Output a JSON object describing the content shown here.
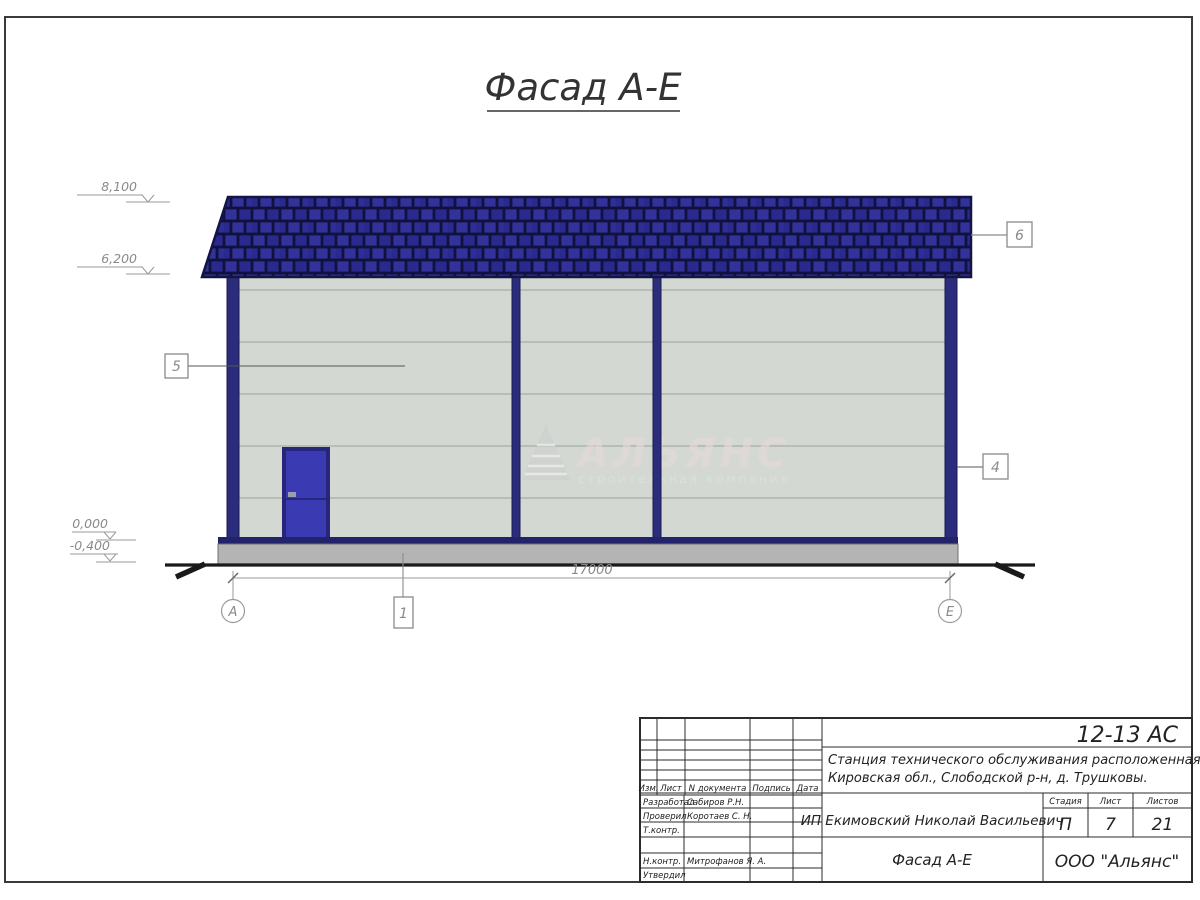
{
  "page": {
    "title": "Фасад А-Е"
  },
  "drawing": {
    "dimension_total": "17000",
    "axis_left": "А",
    "axis_right": "Е",
    "elevations": [
      "8,100",
      "6,200",
      "0,000",
      "-0,400"
    ],
    "callouts": {
      "c1": "1",
      "c4": "4",
      "c5": "5",
      "c6": "6"
    }
  },
  "watermark": {
    "name": "АЛЬЯНС",
    "subtitle": "строительная компания"
  },
  "title_block": {
    "doc_number": "12-13 АС",
    "project_line1": "Станция технического обслуживания расположенная по адресу",
    "project_line2": "Кировская обл., Слободской р-н, д. Трушковы.",
    "client": "ИП Екимовский Николай Васильевич",
    "sheet_title": "Фасад А-Е",
    "company": "ООО \"Альянс\"",
    "columns": {
      "izm": "Изм.",
      "list": "Лист",
      "doc": "N документа",
      "sign": "Подпись",
      "date": "Дата"
    },
    "rows": [
      {
        "role": "Разработал",
        "name": "Сабиров Р.Н."
      },
      {
        "role": "Проверил",
        "name": "Коротаев С. Н."
      },
      {
        "role": "Т.контр.",
        "name": ""
      },
      {
        "role": "Н.контр.",
        "name": "Митрофанов Я. А."
      },
      {
        "role": "Утвердил",
        "name": ""
      }
    ],
    "stage_header": {
      "stage": "Стадия",
      "sheet": "Лист",
      "sheets": "Листов"
    },
    "stage_values": {
      "stage": "П",
      "sheet": "7",
      "sheets": "21"
    }
  },
  "colors": {
    "roof": "#2d2d8c",
    "roof_outline": "#141445",
    "frame_column": "#2c2c7c",
    "wall": "#d3d8d2",
    "door": "#3a3ab2",
    "door_frame": "#26267a",
    "base_band": "#23236b",
    "plinth": "#b4b4b4",
    "ground": "#1a1a1a"
  }
}
